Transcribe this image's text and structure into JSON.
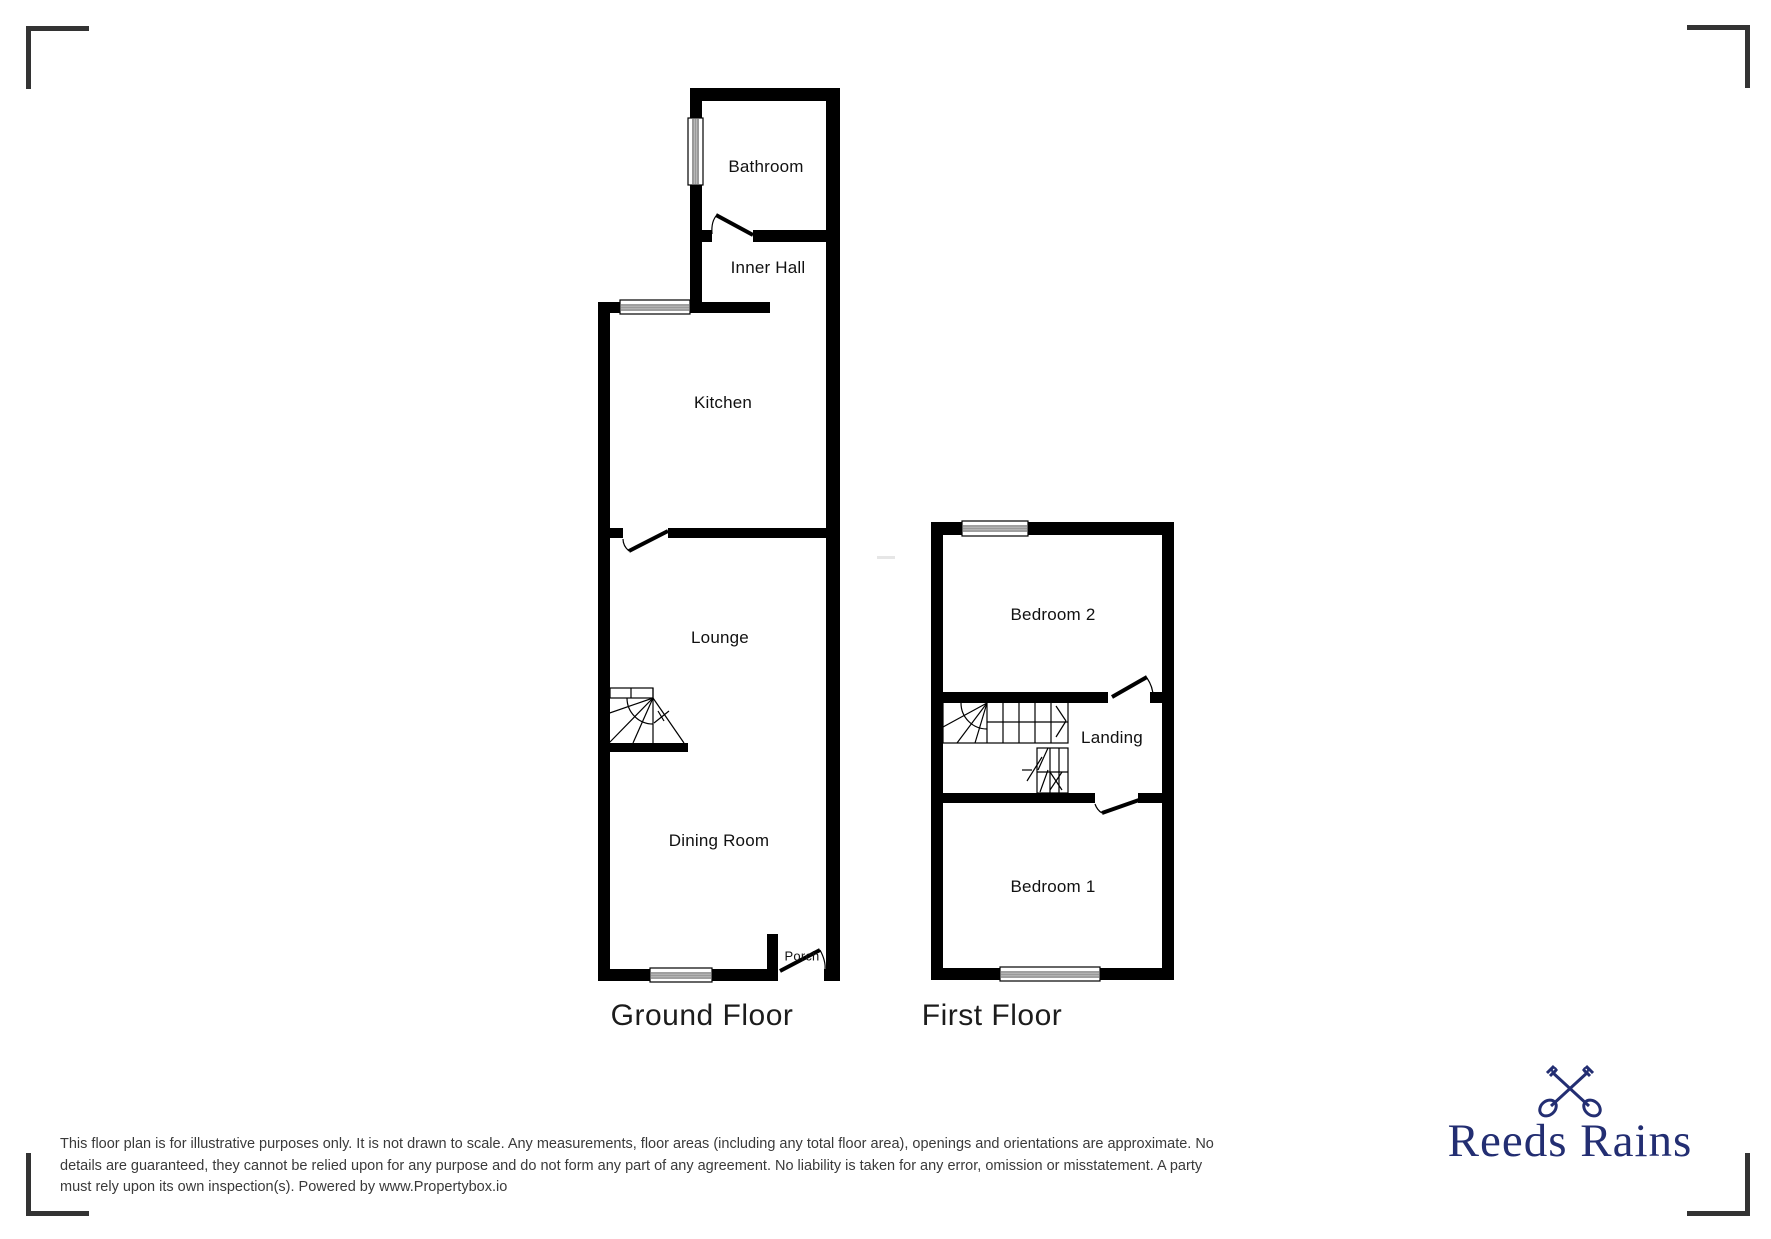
{
  "ground_floor": {
    "title": "Ground Floor",
    "rooms": {
      "bathroom": "Bathroom",
      "inner_hall": "Inner Hall",
      "kitchen": "Kitchen",
      "lounge": "Lounge",
      "dining_room": "Dining Room",
      "porch": "Porch"
    }
  },
  "first_floor": {
    "title": "First Floor",
    "rooms": {
      "bedroom2": "Bedroom 2",
      "landing": "Landing",
      "bedroom1": "Bedroom 1"
    }
  },
  "disclaimer": {
    "lines": [
      "This floor plan is for illustrative purposes only. It is not drawn to scale. Any measurements, floor areas (including any total floor area), openings and orientations are approximate. No",
      "details are guaranteed, they cannot be relied upon for any purpose and do not form any part of any agreement. No liability is taken for any error, omission or misstatement. A party",
      "must rely upon its own inspection(s). Powered by www.Propertybox.io"
    ]
  },
  "logo": {
    "brand": "Reeds Rains",
    "icon": "crossed-keys-icon",
    "color": "#232e72"
  },
  "colors": {
    "walls": "#000000",
    "background": "#ffffff",
    "crop_marks": "#333333",
    "disclaimer_text": "#3a3a3a"
  }
}
